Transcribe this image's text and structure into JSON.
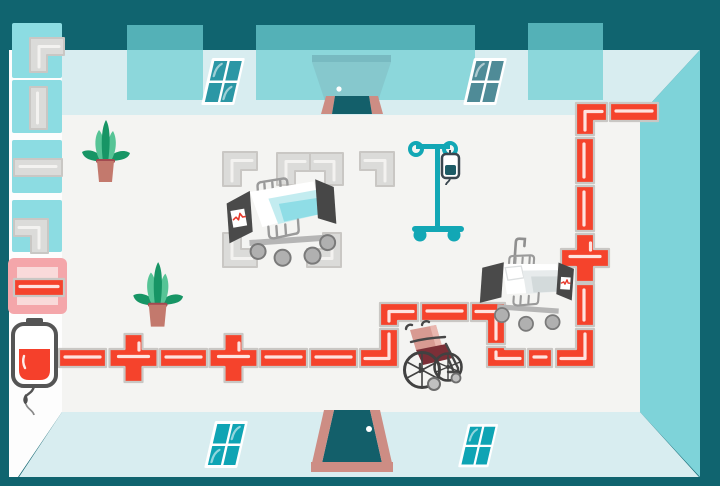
{
  "app": {
    "name": "hospital-pipe-puzzle",
    "description": "Top-down hospital ward scene where a red blood pipeline is routed from a blood bag across the floor between beds, plants, an IV stand and a wheelchair",
    "canvas_width": 720,
    "canvas_height": 486
  },
  "colors": {
    "bg-dark": "#10646f",
    "wall-light": "#d8edf0",
    "wall-side": "#7ed3d9",
    "floor": "#f4f4f2",
    "strip": "#fdfdfd",
    "tile": "#8cdce2",
    "tile-sel-bg": "#f4a6aa",
    "tile-sel-inner": "#f9dada",
    "pipe-red": "#f5432c",
    "pipe-gray": "#dbdbd9",
    "grout": "#c9c7c4",
    "pane-top": "#2b97a5",
    "pane-top2": "#4f8b97",
    "pane-bottom": "#0fa4b4",
    "door-teal": "#135f6a",
    "door-frame": "#cd8d84",
    "panel": "rgba(111,207,211,0.72)",
    "ghost1": "rgba(70,110,125,0.28)",
    "ghost2": "rgba(116,155,165,0.25)",
    "iv-teal": "#12a7b5",
    "iv-bag-outline": "#3a4750",
    "iv-bag-fluid": "#1d5b66",
    "plant-dark": "#179565",
    "plant-light": "#56c496",
    "pot": "#c3796d",
    "pot-rim": "#a34a50",
    "bed-dark": "#4a4a4a",
    "blanket1": "#c3ecf0",
    "blanket2": "#8fdde6",
    "bed2-blanket": "#e7ebec",
    "bed2-stripe": "#d3dadb",
    "metal": "#9a9a9a",
    "wheel-fill": "#b0b0b0",
    "wheel-stroke": "#7a7a7a",
    "chair-pink": "#d89a92",
    "chair-pink2": "#e9b6ae",
    "chair-seat": "#7c2f37",
    "chair-frame": "#474747",
    "caster": "#c0c0c0",
    "blood-red": "#f5402b",
    "dark-gray": "#555555",
    "pulse-red": "#e8392b"
  },
  "inventory": {
    "tray": {
      "x": 9,
      "y": 50,
      "width": 53
    },
    "tiles": [
      {
        "name": "inventory-elbow-right-down",
        "x": 12,
        "y": 23,
        "w": 50,
        "h": 55,
        "piece": {
          "kind": "DR",
          "x": 30,
          "y": 38,
          "ha": 34,
          "va": 34,
          "t": 17
        }
      },
      {
        "name": "inventory-straight-vertical",
        "x": 12,
        "y": 80,
        "w": 50,
        "h": 53,
        "piece": {
          "kind": "v",
          "x": 30,
          "y": 87,
          "h": 42,
          "t": 17
        }
      },
      {
        "name": "inventory-straight-horizontal",
        "x": 12,
        "y": 140,
        "w": 50,
        "h": 53,
        "piece": {
          "kind": "h",
          "x": 14,
          "y": 159,
          "w": 48,
          "t": 17
        }
      },
      {
        "name": "inventory-elbow-left-down",
        "x": 12,
        "y": 200,
        "w": 50,
        "h": 52,
        "piece": {
          "kind": "LD",
          "x": 14,
          "y": 219,
          "ha": 34,
          "va": 34,
          "t": 17
        }
      }
    ],
    "selected_tile": {
      "name": "selected-straight-horizontal",
      "x": 8,
      "y": 258,
      "w": 59,
      "h": 56,
      "piece": {
        "kind": "h",
        "x": 14,
        "y": 279,
        "w": 50,
        "t": 17
      }
    }
  },
  "pipeline": {
    "red_pieces": [
      {
        "name": "pipe-horizontal",
        "kind": "h",
        "x": 59,
        "y": 349,
        "w": 47
      },
      {
        "name": "pipe-cross",
        "kind": "cross",
        "cx": 133.5,
        "cy": 358
      },
      {
        "name": "pipe-horizontal",
        "kind": "h",
        "x": 160,
        "y": 349,
        "w": 47
      },
      {
        "name": "pipe-cross",
        "kind": "cross",
        "cx": 233.5,
        "cy": 358
      },
      {
        "name": "pipe-horizontal",
        "kind": "h",
        "x": 260,
        "y": 349,
        "w": 47
      },
      {
        "name": "pipe-horizontal",
        "kind": "h",
        "x": 310,
        "y": 349,
        "w": 47
      },
      {
        "name": "pipe-elbow-left-up",
        "kind": "LU",
        "x": 360,
        "y": 329,
        "ha": 38,
        "va": 38
      },
      {
        "name": "pipe-elbow-down-right",
        "kind": "DR",
        "x": 380,
        "y": 303,
        "ha": 38,
        "va": 23
      },
      {
        "name": "pipe-horizontal",
        "kind": "h",
        "x": 421,
        "y": 303,
        "w": 47
      },
      {
        "name": "pipe-elbow-left-down",
        "kind": "LD",
        "x": 471,
        "y": 303,
        "ha": 34,
        "va": 41
      },
      {
        "name": "pipe-elbow-up-right",
        "kind": "UR",
        "x": 487,
        "y": 347,
        "ha": 38,
        "va": 20
      },
      {
        "name": "pipe-horizontal",
        "kind": "h",
        "x": 528,
        "y": 349,
        "w": 24
      },
      {
        "name": "pipe-elbow-left-up",
        "kind": "LU",
        "x": 556,
        "y": 329,
        "ha": 38,
        "va": 38
      },
      {
        "name": "pipe-vertical",
        "kind": "v",
        "x": 576,
        "y": 284,
        "h": 42
      },
      {
        "name": "pipe-cross",
        "kind": "cross",
        "cx": 585,
        "cy": 258
      },
      {
        "name": "pipe-vertical",
        "kind": "v",
        "x": 576,
        "y": 186,
        "h": 45
      },
      {
        "name": "pipe-vertical",
        "kind": "v",
        "x": 576,
        "y": 138,
        "h": 45
      },
      {
        "name": "pipe-elbow-down-right",
        "kind": "DR",
        "x": 576,
        "y": 103,
        "ha": 31,
        "va": 32
      },
      {
        "name": "pipe-horizontal",
        "kind": "h",
        "x": 610,
        "y": 103,
        "w": 48
      }
    ],
    "ghost_pieces": [
      {
        "name": "ghost-elbow-right-down",
        "kind": "DR",
        "x": 223,
        "y": 152,
        "ha": 34,
        "va": 34
      },
      {
        "name": "ghost-elbow-right-down",
        "kind": "DR",
        "x": 277,
        "y": 153,
        "ha": 33,
        "va": 32
      },
      {
        "name": "ghost-elbow-left-down",
        "kind": "LD",
        "x": 310,
        "y": 153,
        "ha": 33,
        "va": 32
      },
      {
        "name": "ghost-elbow-left-down",
        "kind": "LD",
        "x": 360,
        "y": 152,
        "ha": 34,
        "va": 34
      },
      {
        "name": "ghost-elbow-up-right",
        "kind": "UR",
        "x": 223,
        "y": 233,
        "ha": 34,
        "va": 34
      },
      {
        "name": "ghost-elbow-left-up",
        "kind": "LU",
        "x": 307,
        "y": 233,
        "ha": 34,
        "va": 34
      }
    ]
  },
  "objects": [
    "blood-bag-source",
    "hospital-bed-1",
    "hospital-bed-2",
    "iv-stand",
    "wheelchair",
    "plant-1",
    "plant-2",
    "top-door",
    "bottom-door",
    "window-top-left",
    "window-top-right",
    "window-bottom-left",
    "window-bottom-right",
    "wall-panel-1",
    "wall-panel-2",
    "wall-panel-3"
  ]
}
